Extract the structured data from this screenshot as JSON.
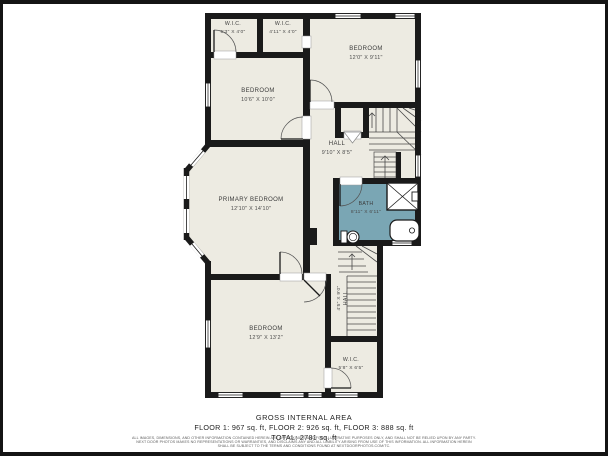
{
  "rooms": {
    "wic1": {
      "name": "W.I.C.",
      "dims": "5'3\" X 4'0\""
    },
    "wic2": {
      "name": "W.I.C.",
      "dims": "4'11\" X 4'0\""
    },
    "bedroom_top_right": {
      "name": "BEDROOM",
      "dims": "12'0\" X 9'11\""
    },
    "bedroom_mid_left": {
      "name": "BEDROOM",
      "dims": "10'6\" X 10'0\""
    },
    "hall": {
      "name": "HALL",
      "dims": "9'10\" X 8'5\""
    },
    "primary_bedroom": {
      "name": "PRIMARY BEDROOM",
      "dims": "12'10\" X 14'10\""
    },
    "bath": {
      "name": "BATH",
      "dims": "8'11\" X 6'11\""
    },
    "hall_lower": {
      "name": "HALL",
      "dims": "4'5\" X 9'0\""
    },
    "bedroom_bottom": {
      "name": "BEDROOM",
      "dims": "12'9\" X 13'2\""
    },
    "wic3": {
      "name": "W.I.C.",
      "dims": "5'8\" X 6'5\""
    }
  },
  "footer": {
    "title": "GROSS INTERNAL AREA",
    "floors_line": "FLOOR 1: 967 sq. ft, FLOOR 2: 926 sq. ft, FLOOR 3: 888 sq. ft",
    "total_line": "TOTAL: 2781 sq. ft",
    "disclaimer_line1": "ALL IMAGES, DIMENSIONS, AND OTHER INFORMATION CONTAINED HEREIN ARE APPROXIMATE AND FOR ILLUSTRATIVE PURPOSES ONLY, AND SHALL NOT BE RELIED UPON BY ANY PARTY.",
    "disclaimer_line2": "NEXT DOOR PHOTOS MAKES NO REPRESENTATIONS OR WARRANTIES, AND DISCLAIMS ANY AND ALL LIABILITY ARISING FROM USE OF THIS INFORMATION. ALL INFORMATION HEREIN",
    "disclaimer_line3": "SHALL BE SUBJECT TO THE TERMS AND CONDITIONS FOUND AT NEXTDOORPHOTOS.COM/TC."
  },
  "colors": {
    "wall": "#1a1a1a",
    "room_fill": "#edebe2",
    "bath_fill": "#7aa6b4",
    "frame": "#141414",
    "background": "#ffffff",
    "label_text": "#3b3b3b"
  }
}
